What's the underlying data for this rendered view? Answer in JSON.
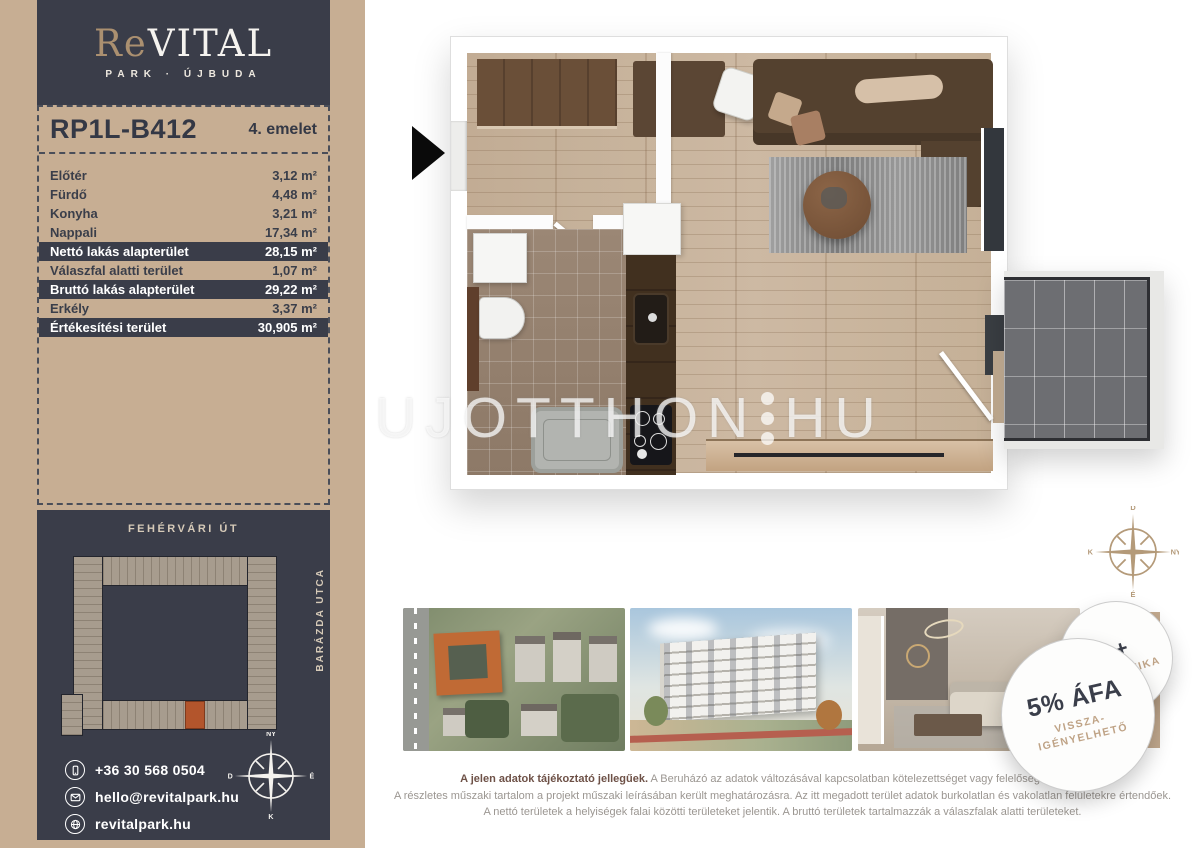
{
  "brand": {
    "re": "Re",
    "vital": "VITAL",
    "subtitle": "PARK · ÚJBUDA"
  },
  "unit": {
    "code": "RP1L-B412",
    "floor": "4. emelet"
  },
  "areas": {
    "rows": [
      {
        "label": "Előtér",
        "value": "3,12 m²"
      },
      {
        "label": "Fürdő",
        "value": "4,48 m²"
      },
      {
        "label": "Konyha",
        "value": "3,21 m²"
      },
      {
        "label": "Nappali",
        "value": "17,34 m²"
      },
      {
        "label": "Nettó lakás alapterület",
        "value": "28,15 m²"
      },
      {
        "label": "Válaszfal alatti terület",
        "value": "1,07 m²"
      },
      {
        "label": "Bruttó lakás alapterület",
        "value": "29,22 m²"
      },
      {
        "label": "Erkély",
        "value": "3,37 m²"
      },
      {
        "label": "Értékesítési terület",
        "value": "30,905 m²"
      }
    ]
  },
  "site": {
    "street_top": "FEHÉRVÁRI ÚT",
    "street_right": "BARÁZDA UTCA"
  },
  "contact": {
    "phone": "+36 30 568 0504",
    "email": "hello@revitalpark.hu",
    "website": "revitalpark.hu"
  },
  "watermark": {
    "part1": "UJOTTHON",
    "part2": "HU"
  },
  "compass_sidebar": {
    "top": "NY",
    "right": "É",
    "bottom": "K",
    "left": "D"
  },
  "compass_plan": {
    "top": "D",
    "right": "NY",
    "bottom": "É",
    "left": "K"
  },
  "badges": {
    "energy_class": "A+",
    "energy_word": "ENERGETIKA",
    "vat_title": "5% ÁFA",
    "vat_line1": "VISSZA-",
    "vat_line2": "IGÉNYELHETŐ"
  },
  "disclaimer": {
    "lead": "A jelen adatok tájékoztató jellegűek.",
    "line1_rest": " A Beruházó az adatok változásával kapcsolatban kötelezettséget vagy felelőséget nem vállal.",
    "line2": "A részletes műszaki tartalom a projekt műszaki leírásában került meghatározásra. Az itt megadott terület adatok burkolatlan és vakolatlan felületekre értendőek.",
    "line3": "A nettó területek a helyiségek falai közötti területeket jelentik. A bruttó területek tartalmazzák a válaszfalak alatti területeket."
  },
  "colors": {
    "sidebar_tan": "#c7ae93",
    "navy": "#3a3d49",
    "logo_accent": "#ab9070",
    "highlight_orange": "#b3552c",
    "badge_sub_tan": "#bfa386"
  }
}
